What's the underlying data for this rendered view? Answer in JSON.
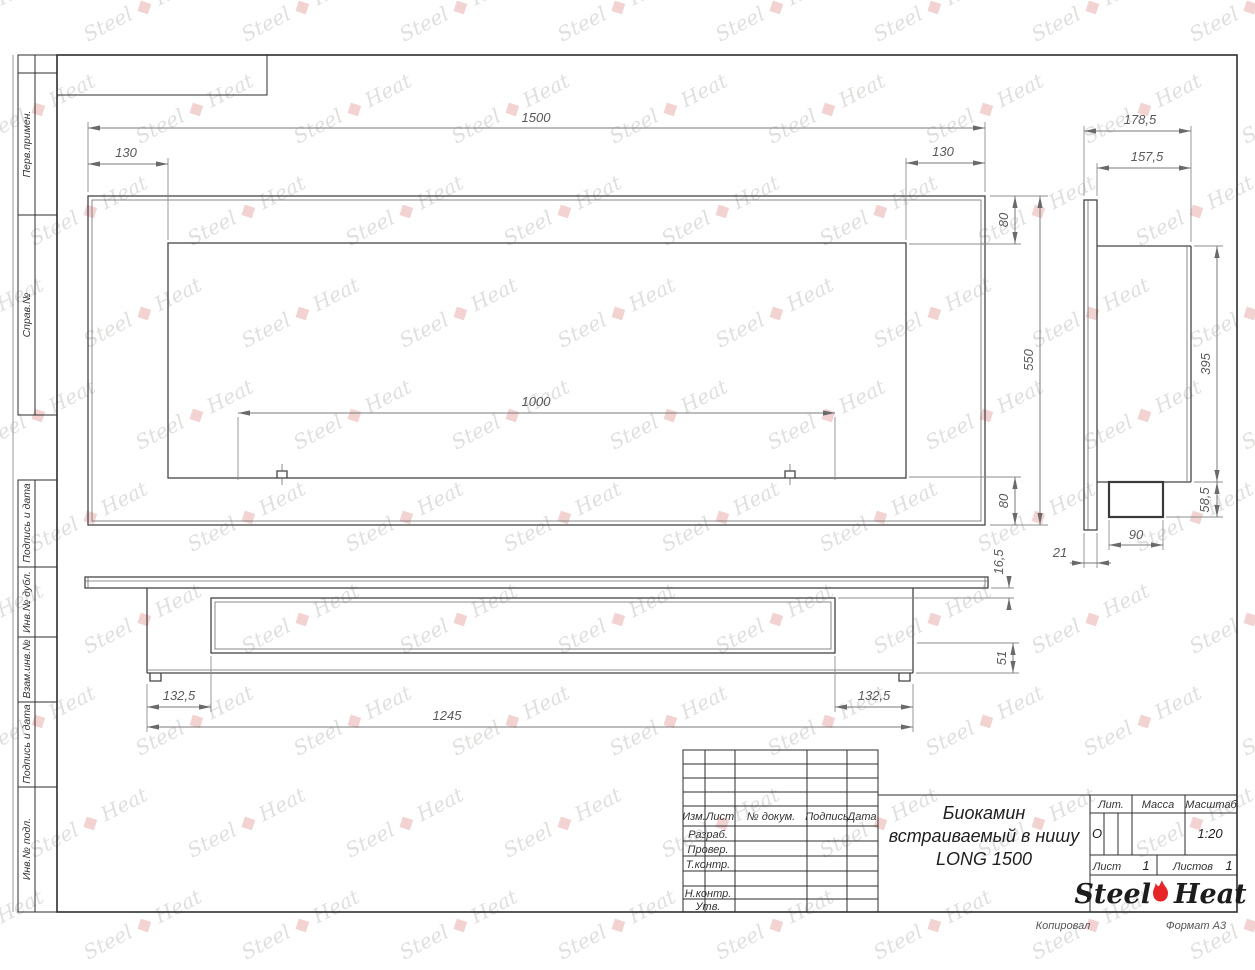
{
  "sheet": {
    "copied_label": "Копировал",
    "format_label": "Формат А3"
  },
  "margin": {
    "top_labels": [
      "Перв.примен.",
      "Справ.№"
    ],
    "bottom_labels": [
      "Подпись и дата",
      "Инв.№ дубл.",
      "Взам.инв.№",
      "Подпись и дата",
      "Инв.№ подл."
    ]
  },
  "title_block": {
    "header": {
      "izm": "Изм.",
      "list": "Лист",
      "doc": "№ докум.",
      "sign": "Подпись",
      "date": "Дата"
    },
    "roles": {
      "developed": "Разраб.",
      "checked": "Провер.",
      "tcontrol": "Т.контр.",
      "ncontrol": "Н.контр.",
      "approved": "Утв."
    },
    "title_line1": "Биокамин",
    "title_line2": "встраиваемый в нишу",
    "title_line3": "LONG 1500",
    "lit_label": "Лит.",
    "lit_value": "О",
    "mass_label": "Масса",
    "scale_label": "Масштаб",
    "scale_value": "1:20",
    "sheet_label": "Лист",
    "sheet_value": "1",
    "sheets_label": "Листов",
    "sheets_value": "1"
  },
  "logo": {
    "word1": "Steel",
    "word2": "Heat"
  },
  "watermark": {
    "word1": "Steel",
    "word2": "Heat",
    "flame_glyph": "◆"
  },
  "drawing": {
    "front": {
      "total_width": "1500",
      "left_inset": "130",
      "right_inset": "130",
      "top_inset": "80",
      "height": "550",
      "bottom_inset": "80",
      "inner_width": "1000"
    },
    "side": {
      "total_depth": "178,5",
      "body_depth": "157,5",
      "body_height": "395",
      "tray_height": "58,5",
      "tray_depth": "90",
      "panel_thickness": "21"
    },
    "bottom": {
      "panel_offset": "16,5",
      "tray_drop": "51",
      "left_inset": "132,5",
      "right_inset": "132,5",
      "mount_width": "1245"
    }
  }
}
